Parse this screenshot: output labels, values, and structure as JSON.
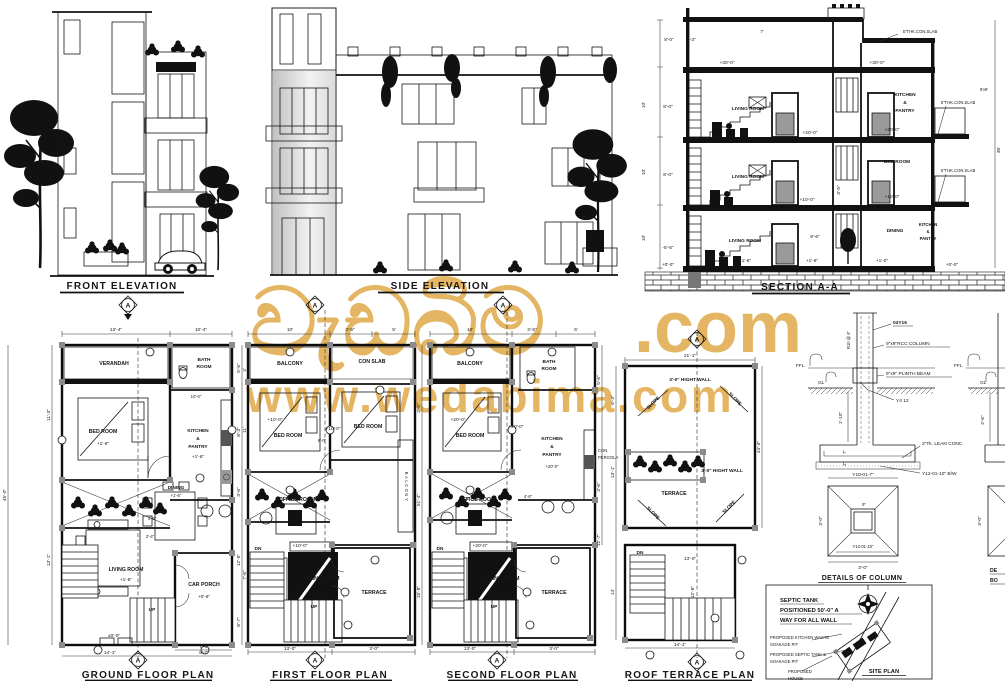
{
  "watermark": {
    "brand": "වැඩබිම",
    "tld": ".com",
    "url": "www.wedabima.com",
    "color": "#E3B35C"
  },
  "markers": {
    "section_letter": "A"
  },
  "elevations": {
    "front_title": "FRONT ELEVATION",
    "side_title": "SIDE ELEVATION"
  },
  "section": {
    "title": "SECTION A-A",
    "slab_note": "5\"THK.CON.SLAB",
    "living_room": "LIVING ROOM",
    "bed_room": "BED ROOM",
    "dining": "DINING",
    "kitchen_pantry": [
      "KITCHEN",
      "&",
      "PANTRY"
    ],
    "levels": {
      "l30": "+30'-0\"",
      "l20": "+20'-0\"",
      "l10": "+10'-0\"",
      "l16": "+1'-6\"",
      "l10b": "+1'-0\"",
      "l0": "+0'-0\"",
      "lm56": "-5'-6\""
    },
    "dims": {
      "d80": "8'-0\"",
      "d93": "9'-3\"",
      "d86": "8'-6\"",
      "d35t": "3'-5\"",
      "total": "35'",
      "d10": "10'",
      "d7": "7'",
      "col": "9'x9'"
    }
  },
  "plans": {
    "ground": {
      "title": "GROUND FLOOR PLAN",
      "verandah": "VERANDAH",
      "bed_room": "BED ROOM",
      "bath": [
        "BATH",
        "ROOM"
      ],
      "kitchen_pantry": [
        "KITCHEN",
        "&",
        "PANTRY"
      ],
      "dining": "DINING",
      "living_room": "LIVING ROOM",
      "car_porch": "CAR PORCH",
      "up": "UP",
      "levels": {
        "l16": "+1'-6\"",
        "l06": "+0'-6\"",
        "l00": "±0'-0\""
      },
      "dims": {
        "top1": "13'-4\"",
        "top2": "10'-4\"",
        "left1": "11'-3\"",
        "left2": "13'-1\"",
        "left_total": "45'-0\"",
        "right1": "5'-6\"",
        "right2": "8'-3\"",
        "right3": "3'-6\"",
        "right4": "12'-5\"",
        "right5": "8'-7\"",
        "bot1": "7'-6\"",
        "bot2": "14'-1\"",
        "bot3": "8'-7\"",
        "mid": "10'-0\"",
        "mid2": "4'-6\"",
        "mid3": "2'-4\""
      }
    },
    "first": {
      "title": "FIRST FLOOR PLAN",
      "balcony": "BALCONY",
      "con_slab": "CON SLAB",
      "bed_room": "BED ROOM",
      "office": "OFFICE ROOM",
      "living_room": "LIVING ROOM",
      "terrace": "TERRACE",
      "balcony_v": "BALCONY",
      "dn": "DN",
      "up": "UP",
      "level": "+10'-0\"",
      "dims": {
        "top1": "10'",
        "top2": "3'-5\"",
        "top3": "5'",
        "mid": "6'-0\"",
        "right1": "2'-6\"",
        "right2": "51'-4\"",
        "right3": "15'-8\"",
        "bot1": "13'-0\"",
        "bot2": "3'-0\"",
        "left1": "4'",
        "left2": "11'",
        "left3": "7'-6\""
      }
    },
    "second": {
      "title": "SECOND FLOOR PLAN",
      "balcony": "BALCONY",
      "bed_room": "BED ROOM",
      "bath": [
        "BATH",
        "ROOM"
      ],
      "kitchen_pantry": [
        "KITCHEN",
        "&",
        "PANTRY"
      ],
      "office": "OFFICE ROOM",
      "living_room": "LIVING ROOM",
      "terrace": "TERRACE",
      "pergola": [
        "CON.",
        "PERGOLA"
      ],
      "dn": "DN",
      "up": "UP",
      "level": "+20'-0\"",
      "dims": {
        "top1": "10'",
        "top2": "3'-5\"",
        "top3": "5'",
        "right1": "5'-6\"",
        "right2": "3'-6\"",
        "right3": "12'-7\"",
        "mid2": "4'-6\"",
        "bot1": "13'-0\"",
        "bot2": "3'-0\""
      }
    },
    "roof": {
      "title": "ROOF TERRACE PLAN",
      "wall_note": "3'-0\" HIGHT WALL",
      "slope": "SLOPE",
      "terrace": "TERRACE",
      "dn": "DN",
      "dims": {
        "top": "21'-1\"",
        "right": "24'-3\"",
        "left1": "6'-3\"",
        "left2": "13'-1\"",
        "left3": "14'",
        "in1": "13'-0\"",
        "in2": "12'-6\"",
        "bot": "14'-1\""
      }
    }
  },
  "details": {
    "title": "DETAILS OF COLUMN",
    "bars": "04Y16",
    "rcc": "9\"x9\"RCC COLUMN",
    "plinth": "9\"x9\" PLINTH BEAM",
    "ffl": "FFL",
    "gl": "GL",
    "y412": "Y4 12",
    "stirrup": "R10 @ 6\"",
    "lean": "2\"Tk. LEAN CONC.",
    "bw": "Y12-01-10\" B/W",
    "y10": "Y10-01-7\"",
    "y12": "Y12-01-10\"",
    "dims": {
      "d110": "1'-10\"",
      "d26": "2'-6\"",
      "d30": "3'-0\"",
      "d9": "9\"",
      "d7": "7\"",
      "d2": "2\""
    },
    "clipped": {
      "l1": "DE",
      "l2": "BO"
    }
  },
  "site": {
    "title": "SITE PLAN",
    "note": [
      "SEPTIC TANK",
      "POSITIONED 50'-0\" A",
      "WAY FOR ALL WALL"
    ],
    "kitchen_pit": [
      "PROPOSED KITCHEN WASTE",
      "SOAKAGE PIT"
    ],
    "septic": [
      "PROPOSED SEPTIC TANK &",
      "SOAKAGE PIT"
    ],
    "house": [
      "PROPOSED",
      "HOUSE"
    ]
  }
}
